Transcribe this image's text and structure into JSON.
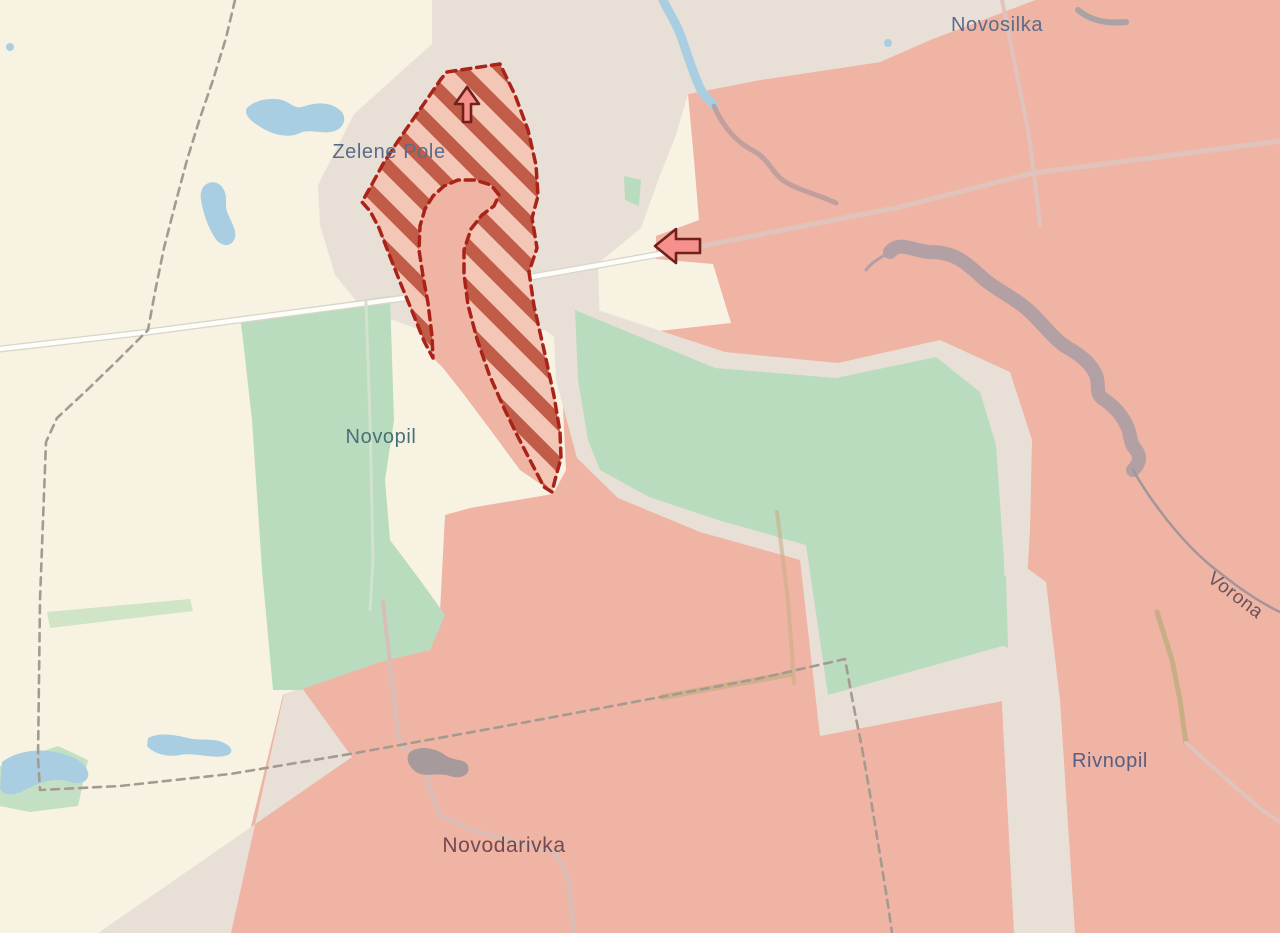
{
  "map": {
    "type": "frontline-war-map",
    "labels": {
      "novosilka": {
        "text": "Novosilka",
        "color": "#5c6b88"
      },
      "zelene_pole": {
        "text": "Zelene Pole",
        "color": "#5a6b89"
      },
      "novopil": {
        "text": "Novopil",
        "color": "#497079"
      },
      "novodarivka": {
        "text": "Novodarivka",
        "color": "#734a50"
      },
      "rivnopil": {
        "text": "Rivnopil",
        "color": "#565e83"
      },
      "river_vorona": {
        "text": "Vorona",
        "color": "#6a545c"
      }
    },
    "zones": {
      "occupied_name": "occupied-area",
      "contested_name": "contested-hatched-area",
      "liberated_pocket_name": "pocket-salient"
    },
    "markers": [
      {
        "icon": "advance-arrow-up-icon",
        "direction": "up"
      },
      {
        "icon": "advance-arrow-left-icon",
        "direction": "left"
      }
    ],
    "colors": {
      "terrain_cream": "#f8f2e2",
      "settlement_taupe": "#e8e0d7",
      "field_green": "#b9dcbe",
      "field_green_light": "#cfe5c6",
      "occupied": "#efb4a4",
      "contested_fill": "#f3c6b6",
      "contested_stripe": "#c15c48",
      "contested_border": "#aa2318",
      "water_blue": "#a9cee1",
      "river_gray": "#b2a0a4",
      "road_white": "#fdfdfa",
      "road_pink": "#e2c3bc",
      "road_tan": "#c9ad86",
      "admin_dash_gray": "#a59a90",
      "arrow_fill": "#f6908d",
      "arrow_stroke": "#6f211a"
    }
  }
}
